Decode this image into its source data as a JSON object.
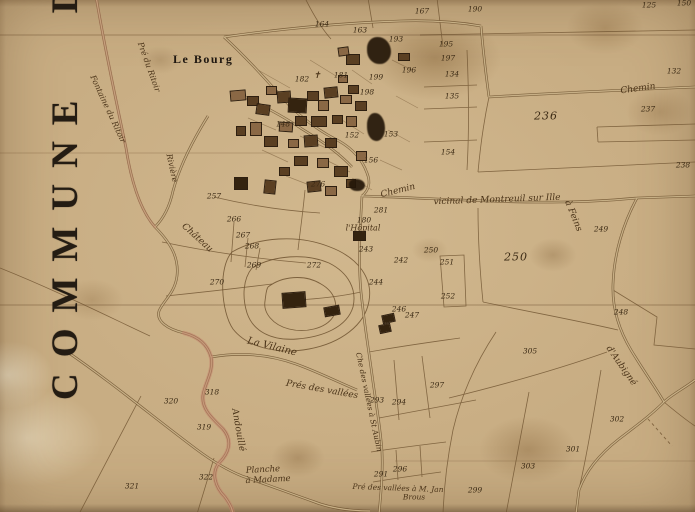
{
  "map": {
    "title": "COMMUNE D",
    "bourg_label": "Le Bourg",
    "palette": {
      "paper": "#c8ad83",
      "ink": "#241c13",
      "parcel_line": "#6f5330",
      "hand_label": "#4a3318",
      "stream_pink": "#c4816b",
      "building_mid": "#5a3f22",
      "building_light": "#8a6845",
      "building_dark": "#34230f"
    },
    "place_labels": [
      {
        "t": "Chemin",
        "x": 638,
        "y": 89,
        "s": 9,
        "r": -8
      },
      {
        "t": "Chemin",
        "x": 398,
        "y": 191,
        "s": 9,
        "r": -14
      },
      {
        "t": "vicinal de Montreuil sur Ille",
        "x": 497,
        "y": 200,
        "s": 9,
        "r": -2
      },
      {
        "t": "à Feins",
        "x": 573,
        "y": 216,
        "s": 9,
        "r": 68
      },
      {
        "t": "Château",
        "x": 197,
        "y": 238,
        "s": 9,
        "r": 42
      },
      {
        "t": "l'Hôpital",
        "x": 363,
        "y": 228,
        "s": 8,
        "r": 0
      },
      {
        "t": "Rivière",
        "x": 172,
        "y": 168,
        "s": 8,
        "r": 78
      },
      {
        "t": "Pré du Ritoir",
        "x": 149,
        "y": 67,
        "s": 8,
        "r": 70
      },
      {
        "t": "Fontaine du Ritoir",
        "x": 108,
        "y": 109,
        "s": 8,
        "r": 65
      },
      {
        "t": "La Vilaine",
        "x": 272,
        "y": 347,
        "s": 10,
        "r": 14
      },
      {
        "t": "Prés des vallées",
        "x": 322,
        "y": 390,
        "s": 9,
        "r": 10
      },
      {
        "t": "Che des vallées à St Aubin",
        "x": 369,
        "y": 402,
        "s": 7.5,
        "r": 78
      },
      {
        "t": "d'Aubigné",
        "x": 621,
        "y": 366,
        "s": 9,
        "r": 55
      },
      {
        "t": "Andouillé",
        "x": 238,
        "y": 430,
        "s": 9,
        "r": 80
      },
      {
        "t": "Planche",
        "x": 263,
        "y": 470,
        "s": 8.5,
        "r": -3
      },
      {
        "t": "à Madame",
        "x": 268,
        "y": 480,
        "s": 8.5,
        "r": -3
      },
      {
        "t": "Pré des vallées à M. Jan",
        "x": 398,
        "y": 488,
        "s": 7.5,
        "r": 2
      },
      {
        "t": "Brous",
        "x": 414,
        "y": 497,
        "s": 7.5,
        "r": 0
      },
      {
        "t": "✝",
        "x": 317,
        "y": 76,
        "s": 9,
        "r": 0
      }
    ],
    "parcel_numbers": [
      {
        "n": "150",
        "x": 684,
        "y": 3
      },
      {
        "n": "125",
        "x": 649,
        "y": 5
      },
      {
        "n": "190",
        "x": 475,
        "y": 9
      },
      {
        "n": "167",
        "x": 422,
        "y": 11
      },
      {
        "n": "164",
        "x": 322,
        "y": 24
      },
      {
        "n": "163",
        "x": 360,
        "y": 30
      },
      {
        "n": "193",
        "x": 396,
        "y": 39
      },
      {
        "n": "195",
        "x": 446,
        "y": 44
      },
      {
        "n": "197",
        "x": 448,
        "y": 58
      },
      {
        "n": "196",
        "x": 409,
        "y": 70
      },
      {
        "n": "134",
        "x": 452,
        "y": 74
      },
      {
        "n": "132",
        "x": 674,
        "y": 71
      },
      {
        "n": "135",
        "x": 452,
        "y": 96
      },
      {
        "n": "236",
        "x": 546,
        "y": 116,
        "big": true
      },
      {
        "n": "237",
        "x": 648,
        "y": 109
      },
      {
        "n": "238",
        "x": 683,
        "y": 165
      },
      {
        "n": "153",
        "x": 391,
        "y": 134
      },
      {
        "n": "154",
        "x": 448,
        "y": 152
      },
      {
        "n": "156",
        "x": 371,
        "y": 160
      },
      {
        "n": "152",
        "x": 352,
        "y": 135
      },
      {
        "n": "148",
        "x": 283,
        "y": 124
      },
      {
        "n": "182",
        "x": 302,
        "y": 79
      },
      {
        "n": "181",
        "x": 341,
        "y": 75
      },
      {
        "n": "199",
        "x": 376,
        "y": 77
      },
      {
        "n": "198",
        "x": 367,
        "y": 92
      },
      {
        "n": "276",
        "x": 318,
        "y": 184
      },
      {
        "n": "281",
        "x": 381,
        "y": 210
      },
      {
        "n": "180",
        "x": 364,
        "y": 220
      },
      {
        "n": "257",
        "x": 214,
        "y": 196
      },
      {
        "n": "266",
        "x": 234,
        "y": 219
      },
      {
        "n": "267",
        "x": 243,
        "y": 235
      },
      {
        "n": "268",
        "x": 252,
        "y": 246
      },
      {
        "n": "269",
        "x": 254,
        "y": 265
      },
      {
        "n": "270",
        "x": 217,
        "y": 282
      },
      {
        "n": "272",
        "x": 314,
        "y": 265
      },
      {
        "n": "243",
        "x": 366,
        "y": 249
      },
      {
        "n": "242",
        "x": 401,
        "y": 260
      },
      {
        "n": "244",
        "x": 376,
        "y": 282
      },
      {
        "n": "246",
        "x": 399,
        "y": 309
      },
      {
        "n": "247",
        "x": 412,
        "y": 315
      },
      {
        "n": "250",
        "x": 431,
        "y": 250
      },
      {
        "n": "251",
        "x": 447,
        "y": 262
      },
      {
        "n": "252",
        "x": 448,
        "y": 296
      },
      {
        "n": "250",
        "x": 516,
        "y": 257,
        "big": true
      },
      {
        "n": "249",
        "x": 601,
        "y": 229
      },
      {
        "n": "248",
        "x": 621,
        "y": 312
      },
      {
        "n": "305",
        "x": 530,
        "y": 351
      },
      {
        "n": "297",
        "x": 437,
        "y": 385
      },
      {
        "n": "293",
        "x": 377,
        "y": 400
      },
      {
        "n": "294",
        "x": 399,
        "y": 402
      },
      {
        "n": "291",
        "x": 381,
        "y": 474
      },
      {
        "n": "296",
        "x": 400,
        "y": 469
      },
      {
        "n": "299",
        "x": 475,
        "y": 490
      },
      {
        "n": "301",
        "x": 573,
        "y": 449
      },
      {
        "n": "302",
        "x": 617,
        "y": 419
      },
      {
        "n": "303",
        "x": 528,
        "y": 466
      },
      {
        "n": "318",
        "x": 212,
        "y": 392
      },
      {
        "n": "319",
        "x": 204,
        "y": 427
      },
      {
        "n": "320",
        "x": 171,
        "y": 401
      },
      {
        "n": "321",
        "x": 132,
        "y": 486
      },
      {
        "n": "322",
        "x": 206,
        "y": 477
      }
    ],
    "buildings": [
      {
        "x": 238,
        "y": 95,
        "w": 14,
        "h": 9,
        "r": -5,
        "c": 1
      },
      {
        "x": 253,
        "y": 101,
        "w": 10,
        "h": 8,
        "r": 0,
        "c": 0
      },
      {
        "x": 263,
        "y": 109,
        "w": 12,
        "h": 9,
        "r": 8,
        "c": 0
      },
      {
        "x": 271,
        "y": 90,
        "w": 9,
        "h": 7,
        "r": 0,
        "c": 1
      },
      {
        "x": 284,
        "y": 97,
        "w": 12,
        "h": 10,
        "r": -4,
        "c": 0
      },
      {
        "x": 297,
        "y": 105,
        "w": 17,
        "h": 13,
        "r": 3,
        "c": 2
      },
      {
        "x": 313,
        "y": 96,
        "w": 10,
        "h": 8,
        "r": 0,
        "c": 0
      },
      {
        "x": 323,
        "y": 105,
        "w": 9,
        "h": 9,
        "r": 0,
        "c": 1
      },
      {
        "x": 331,
        "y": 92,
        "w": 12,
        "h": 9,
        "r": -6,
        "c": 0
      },
      {
        "x": 346,
        "y": 99,
        "w": 10,
        "h": 7,
        "r": 0,
        "c": 1
      },
      {
        "x": 301,
        "y": 121,
        "w": 10,
        "h": 8,
        "r": 0,
        "c": 0
      },
      {
        "x": 286,
        "y": 127,
        "w": 12,
        "h": 8,
        "r": 4,
        "c": 1
      },
      {
        "x": 319,
        "y": 121,
        "w": 14,
        "h": 9,
        "r": 0,
        "c": 0
      },
      {
        "x": 337,
        "y": 119,
        "w": 9,
        "h": 7,
        "r": 0,
        "c": 0
      },
      {
        "x": 256,
        "y": 129,
        "w": 10,
        "h": 12,
        "r": 0,
        "c": 1
      },
      {
        "x": 241,
        "y": 131,
        "w": 8,
        "h": 8,
        "r": 0,
        "c": 0
      },
      {
        "x": 271,
        "y": 141,
        "w": 12,
        "h": 9,
        "r": 0,
        "c": 0
      },
      {
        "x": 293,
        "y": 143,
        "w": 9,
        "h": 7,
        "r": 0,
        "c": 1
      },
      {
        "x": 311,
        "y": 141,
        "w": 12,
        "h": 10,
        "r": -4,
        "c": 0
      },
      {
        "x": 331,
        "y": 143,
        "w": 10,
        "h": 8,
        "r": 0,
        "c": 0
      },
      {
        "x": 351,
        "y": 121,
        "w": 9,
        "h": 9,
        "r": 0,
        "c": 1
      },
      {
        "x": 361,
        "y": 106,
        "w": 10,
        "h": 8,
        "r": 0,
        "c": 0
      },
      {
        "x": 353,
        "y": 89,
        "w": 9,
        "h": 7,
        "r": 0,
        "c": 0
      },
      {
        "x": 343,
        "y": 79,
        "w": 8,
        "h": 6,
        "r": 0,
        "c": 1
      },
      {
        "x": 301,
        "y": 161,
        "w": 12,
        "h": 8,
        "r": 0,
        "c": 0
      },
      {
        "x": 323,
        "y": 163,
        "w": 10,
        "h": 8,
        "r": 0,
        "c": 1
      },
      {
        "x": 284,
        "y": 171,
        "w": 9,
        "h": 7,
        "r": 0,
        "c": 0
      },
      {
        "x": 341,
        "y": 171,
        "w": 12,
        "h": 9,
        "r": 0,
        "c": 0
      },
      {
        "x": 361,
        "y": 156,
        "w": 9,
        "h": 8,
        "r": 0,
        "c": 1
      },
      {
        "x": 353,
        "y": 59,
        "w": 12,
        "h": 9,
        "r": 0,
        "c": 0
      },
      {
        "x": 343,
        "y": 51,
        "w": 9,
        "h": 7,
        "r": -8,
        "c": 1
      },
      {
        "x": 314,
        "y": 186,
        "w": 12,
        "h": 9,
        "r": -6,
        "c": 0
      },
      {
        "x": 331,
        "y": 191,
        "w": 10,
        "h": 8,
        "r": 0,
        "c": 1
      },
      {
        "x": 351,
        "y": 183,
        "w": 8,
        "h": 7,
        "r": 0,
        "c": 0
      },
      {
        "x": 270,
        "y": 187,
        "w": 10,
        "h": 12,
        "r": 6,
        "c": 0
      },
      {
        "x": 241,
        "y": 183,
        "w": 12,
        "h": 11,
        "r": 0,
        "c": 2
      },
      {
        "x": 404,
        "y": 57,
        "w": 10,
        "h": 6,
        "r": 0,
        "c": 0
      },
      {
        "x": 359,
        "y": 236,
        "w": 11,
        "h": 8,
        "r": 0,
        "c": 2
      },
      {
        "x": 388,
        "y": 318,
        "w": 11,
        "h": 7,
        "r": -12,
        "c": 2
      },
      {
        "x": 385,
        "y": 328,
        "w": 10,
        "h": 7,
        "r": -12,
        "c": 2
      },
      {
        "x": 294,
        "y": 300,
        "w": 22,
        "h": 14,
        "r": -4,
        "c": 2
      },
      {
        "x": 332,
        "y": 311,
        "w": 14,
        "h": 8,
        "r": -10,
        "c": 2
      }
    ],
    "ink_blobs": [
      {
        "x": 379,
        "y": 50,
        "w": 24,
        "h": 27
      },
      {
        "x": 376,
        "y": 127,
        "w": 18,
        "h": 28
      },
      {
        "x": 357,
        "y": 185,
        "w": 16,
        "h": 12
      }
    ]
  }
}
